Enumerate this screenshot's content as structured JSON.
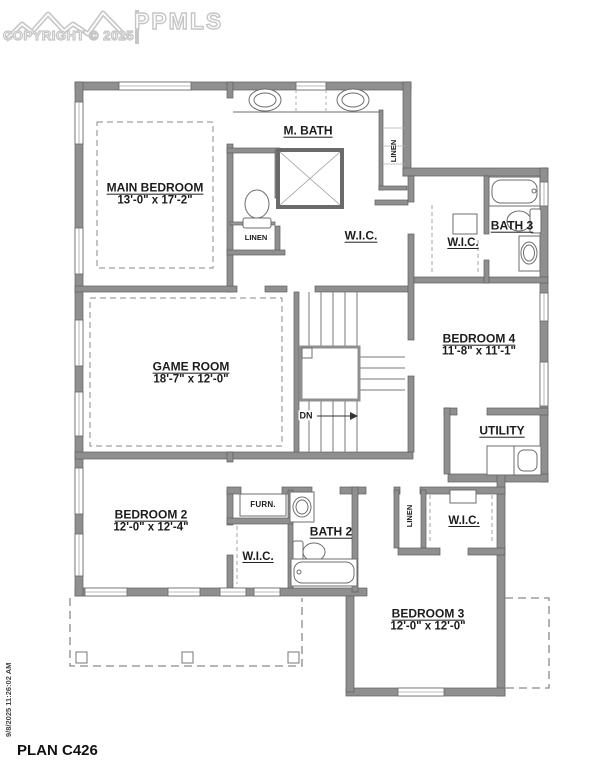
{
  "meta": {
    "logo_text": "PPMLS",
    "copyright": "COPYRIGHT © 2025",
    "plan_title": "PLAN C426",
    "timestamp": "9/8/2025 11:26:02 AM"
  },
  "rooms": {
    "m_bath": {
      "label": "M. BATH"
    },
    "main_bedroom": {
      "label": "MAIN BEDROOM",
      "dims": "13'-0\" x 17'-2\""
    },
    "wic_main": {
      "label": "W.I.C."
    },
    "wic_bath3": {
      "label": "W.I.C."
    },
    "bath3": {
      "label": "BATH 3"
    },
    "bedroom4": {
      "label": "BEDROOM 4",
      "dims": "11'-8\" x 11'-1\""
    },
    "game_room": {
      "label": "GAME ROOM",
      "dims": "18'-7\" x 12'-0\""
    },
    "utility": {
      "label": "UTILITY"
    },
    "bedroom2": {
      "label": "BEDROOM 2",
      "dims": "12'-0\" x 12'-4\""
    },
    "furnace": {
      "label": "FURN."
    },
    "wic_bedroom2": {
      "label": "W.I.C."
    },
    "bath2": {
      "label": "BATH 2"
    },
    "bedroom3": {
      "label": "BEDROOM 3",
      "dims": "12'-0\" x 12'-0\""
    },
    "wic_bedroom3": {
      "label": "W.I.C."
    },
    "linen_mbath": {
      "label": "LINEN"
    },
    "linen_wc": {
      "label": "LINEN"
    },
    "linen_hall": {
      "label": "LINEN"
    },
    "stairs_down": {
      "label": "DN"
    }
  }
}
